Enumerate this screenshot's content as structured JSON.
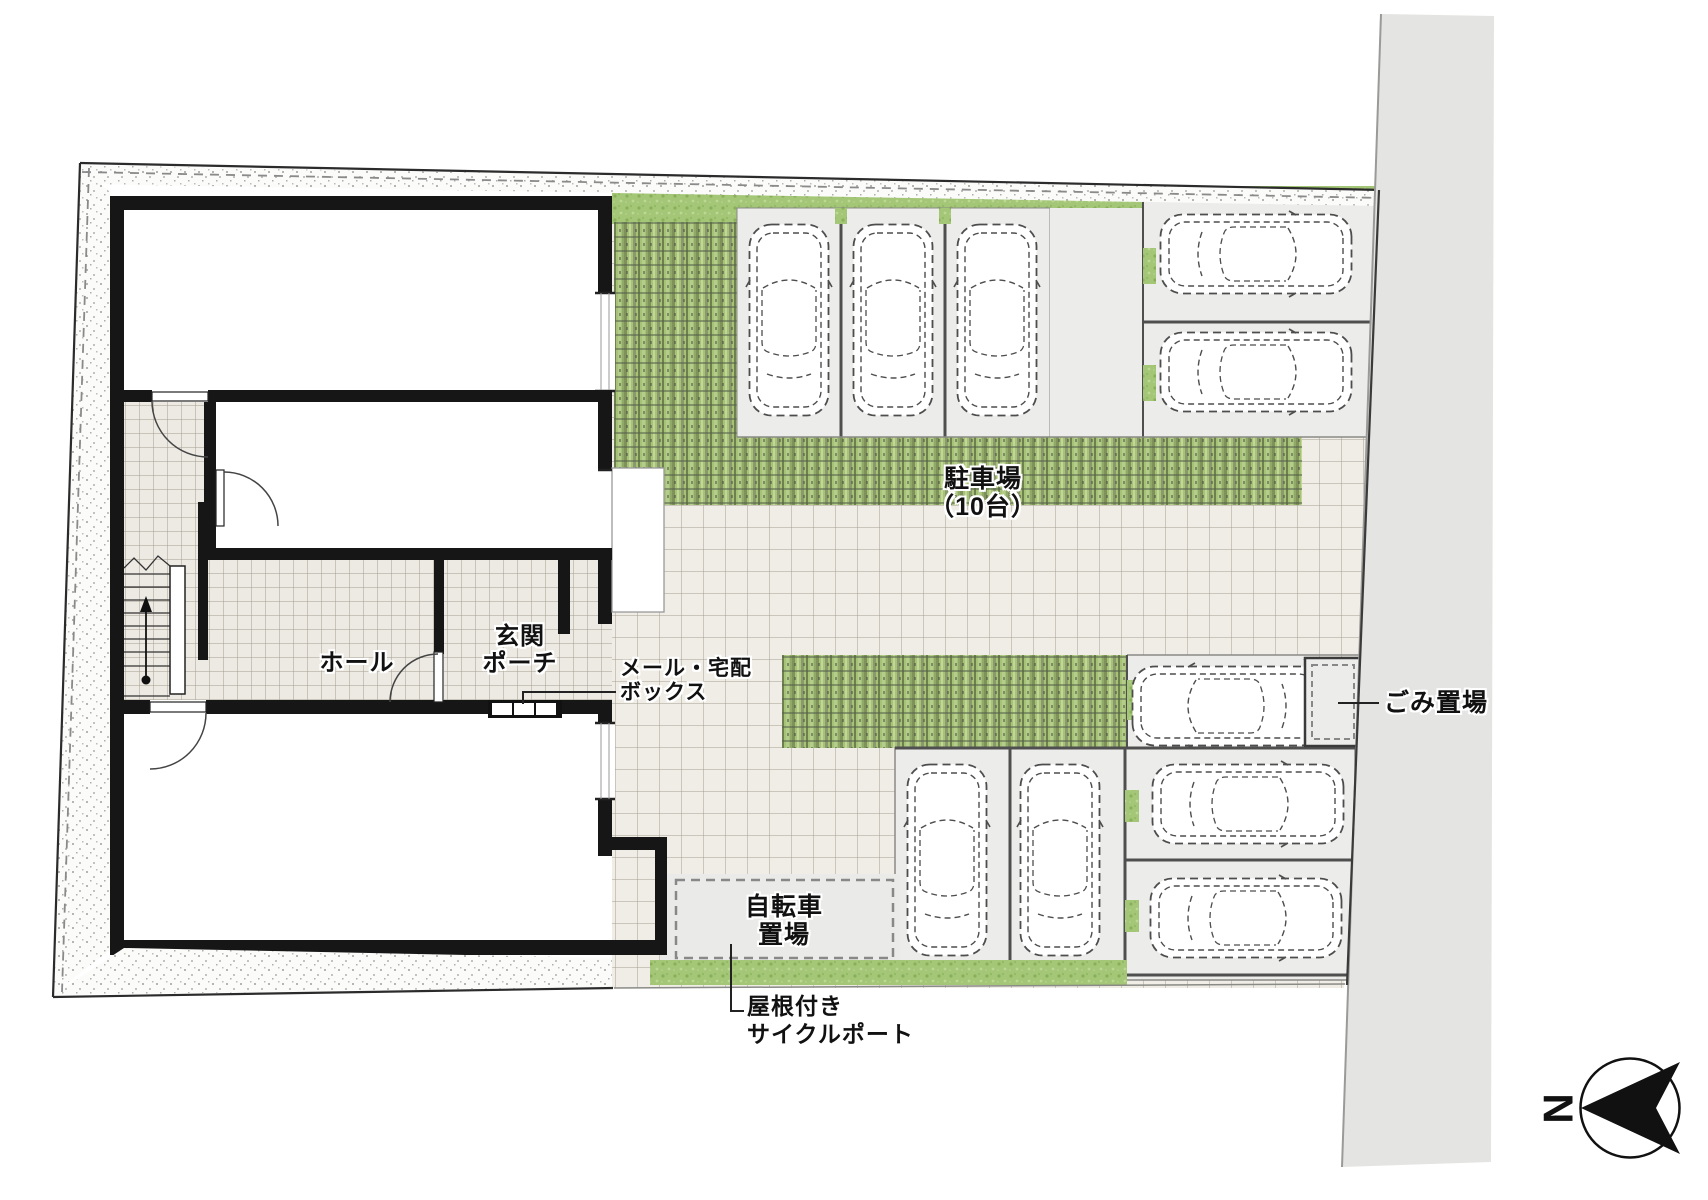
{
  "plan_title": "賃貸住宅 配置図（敷地・駐車場計画）",
  "labels": {
    "parking": {
      "line1": "駐車場",
      "line2": "（10台）"
    },
    "hall": "ホール",
    "porch": {
      "line1": "玄関",
      "line2": "ポーチ"
    },
    "mailbox": {
      "line1": "メール・宅配",
      "line2": "ボックス"
    },
    "trash": "ごみ置場",
    "bicycle": {
      "line1": "自転車",
      "line2": "置場"
    },
    "cycleport": {
      "line1": "屋根付き",
      "line2": "サイクルポート"
    },
    "compass_north": "N"
  },
  "facts": {
    "car_spaces_total": 10,
    "cars_drawn": 10,
    "areas": [
      "駐車場（10台）",
      "ホール",
      "玄関ポーチ",
      "メール・宅配ボックス",
      "ごみ置場",
      "自転車置場（屋根付きサイクルポート）"
    ]
  },
  "colors": {
    "grass_green": "#a3c776",
    "stripe_paver_green": "#a6c375",
    "tile_beige": "#f0ede6",
    "stall_gray": "#ececea",
    "road_gray": "#e4e4e2",
    "wall_black": "#161616",
    "car_outline": "#4d4d4d"
  }
}
